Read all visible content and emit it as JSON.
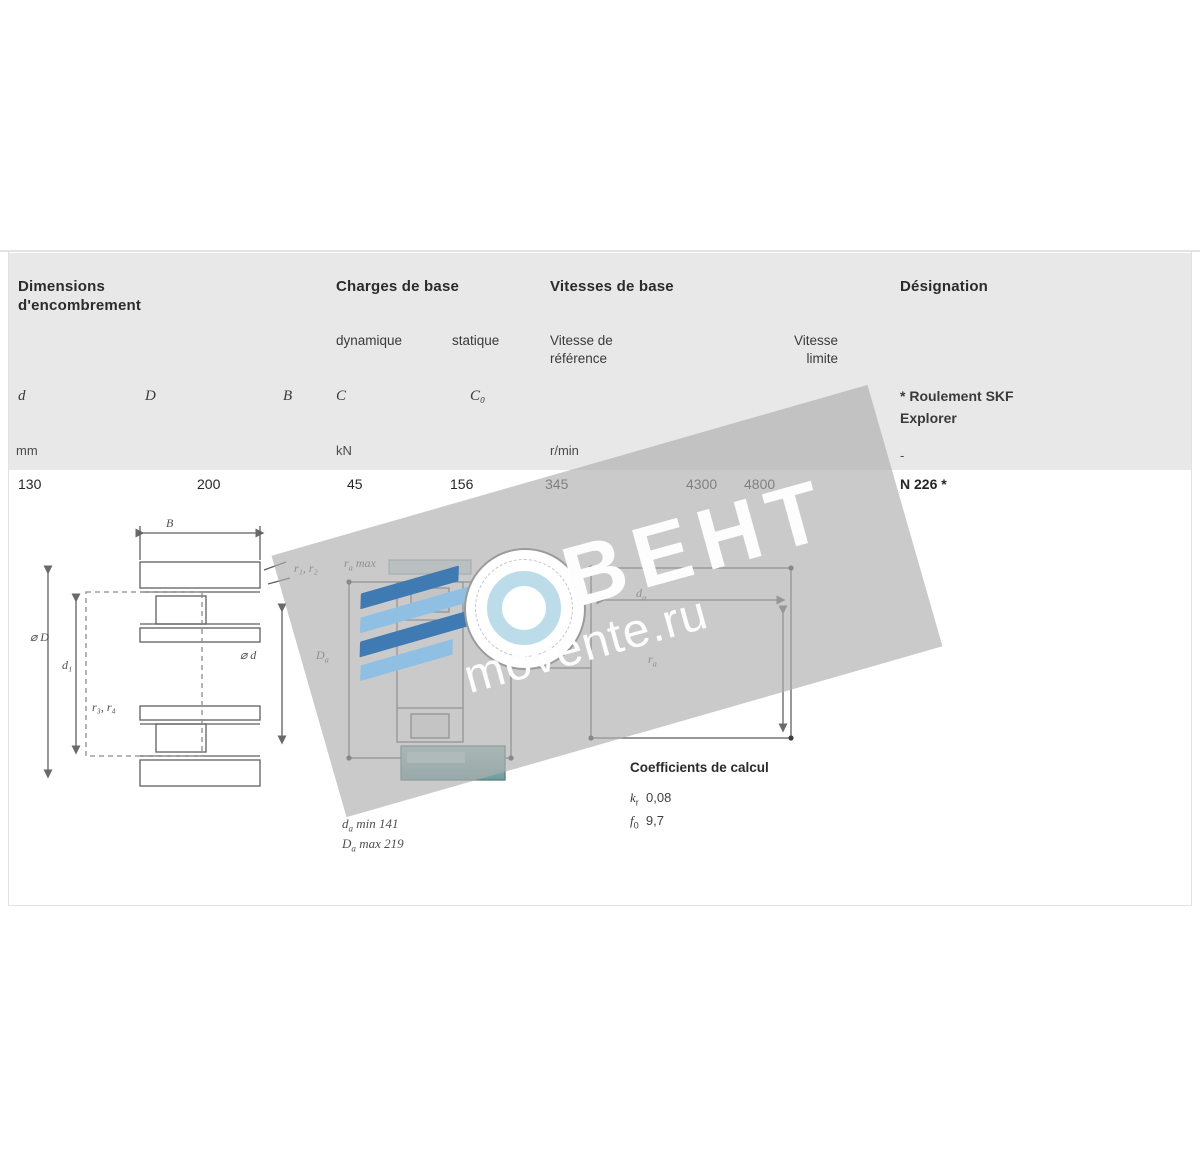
{
  "table": {
    "dims_title_l1": "Dimensions",
    "dims_title_l2": "d'encombrement",
    "loads_title": "Charges de base",
    "speeds_title": "Vitesses de base",
    "designation_title": "Désignation",
    "load_dynamic": "dynamique",
    "load_static": "statique",
    "speed_ref_l1": "Vitesse de",
    "speed_ref_l2": "référence",
    "speed_lim_l1": "Vitesse",
    "speed_lim_l2": "limite",
    "note_l1": "* Roulement SKF",
    "note_l2": "Explorer",
    "symbols": {
      "d": "d",
      "D": "D",
      "B": "B",
      "C": "C",
      "C0": "C₀"
    },
    "units": {
      "mm": "mm",
      "kn": "kN",
      "rpm": "r/min",
      "dash": "-"
    },
    "row": {
      "d": "130",
      "D": "200",
      "B": "45",
      "C": "156",
      "C0": "345",
      "v_ref": "4300",
      "v_lim": "4800",
      "designation": "N 226 *"
    }
  },
  "left_drawing": {
    "dim_B": "B",
    "dim_r12": "r₁, r₂",
    "dim_D": "⌀ D",
    "dim_d1": "d₁",
    "dim_d": "⌀ d",
    "dim_r34": "r₃, r₄"
  },
  "middle_drawing": {
    "ra_max": {
      "base": "r",
      "sub": "a",
      "suffix": " max"
    },
    "Da": {
      "base": "D",
      "sub": "a",
      "suffix": ""
    },
    "da": {
      "base": "d",
      "sub": "a",
      "suffix": ""
    },
    "ra": {
      "base": "r",
      "sub": "a",
      "suffix": ""
    },
    "note1": {
      "base": "d",
      "sub": "a",
      "suffix": " min 141"
    },
    "note2": {
      "base": "D",
      "sub": "a",
      "suffix": " max 219"
    }
  },
  "calc": {
    "title": "Coefficients de calcul",
    "k_base": "k",
    "k_sub": "r",
    "k_value": "0,08",
    "f_base": "f",
    "f_sub": "0",
    "f_value": "9,7"
  },
  "watermark": {
    "brand": "ВЕНТ",
    "site": "movente.ru"
  },
  "colors": {
    "header_bg": "#e8e8e8",
    "band_gray": "#afafaf",
    "teal": "#7aa9a8",
    "blue_dark": "#3f7ab2",
    "blue_light": "#8fc0e4",
    "ring_blue": "#bcdce9"
  }
}
